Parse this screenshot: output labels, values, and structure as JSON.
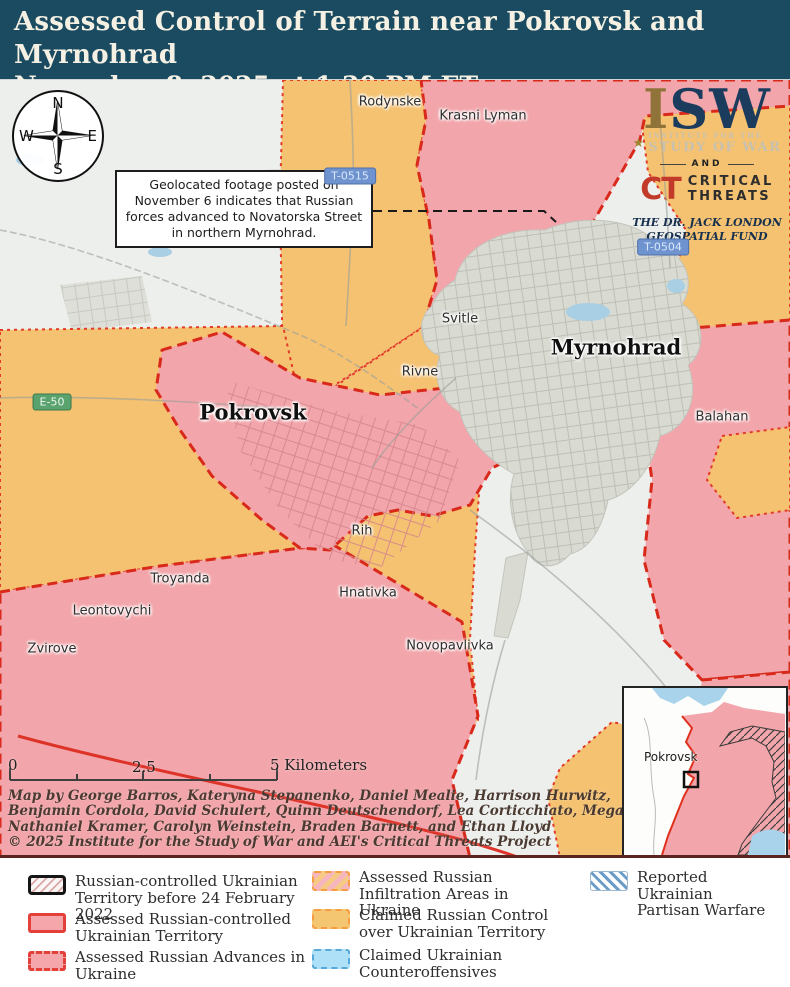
{
  "title": {
    "line1": "Assessed Control of Terrain near Pokrovsk and Myrnohrad",
    "line2": "November 8, 2025 at 1:30 PM ET"
  },
  "compass": {
    "n": "N",
    "e": "E",
    "s": "S",
    "w": "W"
  },
  "annotation": {
    "lines": [
      "Geolocated footage posted on",
      "November 6 indicates that Russian",
      "forces advanced to Novatorska Street",
      "in northern Myrnohrad."
    ]
  },
  "logo": {
    "isw_i": "I",
    "isw_sw": "SW",
    "star": "★",
    "institute": "INSTITUTE FOR THE",
    "study": "STUDY OF WAR",
    "and": "AND",
    "ct": "CT",
    "critical": "CRITICAL",
    "threats": "THREATS",
    "fund1": "THE DR. JACK LONDON",
    "fund2": "GEOSPATIAL FUND"
  },
  "roads": {
    "t0515": "T-0515",
    "t0504": "T-0504",
    "e50": "E-50"
  },
  "cities": [
    {
      "name": "Pokrovsk"
    },
    {
      "name": "Myrnohrad"
    }
  ],
  "towns": [
    {
      "name": "Rodynske"
    },
    {
      "name": "Krasni Lyman"
    },
    {
      "name": "Svitle"
    },
    {
      "name": "Rivne"
    },
    {
      "name": "Balahan"
    },
    {
      "name": "Rih"
    },
    {
      "name": "Troyanda"
    },
    {
      "name": "Hnativka"
    },
    {
      "name": "Leontovychi"
    },
    {
      "name": "Zvirove"
    },
    {
      "name": "Novopavlivka"
    }
  ],
  "scalebar": {
    "zero": "0",
    "mid": "2.5",
    "end": "5 Kilometers"
  },
  "credits": {
    "lines": [
      "Map by George Barros, Kateryna Stepanenko, Daniel Mealie, Harrison Hurwitz,",
      "Benjamin Cordola, David Schulert, Quinn Deutschendorf, Lea Corticchiato, Megan Ewert,",
      "Nathaniel Kramer, Carolyn Weinstein, Braden Barnett, and Ethan Lloyd",
      "© 2025 Institute for the Study of War and AEI's Critical Threats Project"
    ]
  },
  "inset": {
    "label": "Pokrovsk"
  },
  "legend": {
    "items": [
      {
        "label": "Russian-controlled Ukrainian Territory before 24 February 2022"
      },
      {
        "label": "Assessed Russian-controlled Ukrainian Territory"
      },
      {
        "label": "Assessed Russian Advances in Ukraine"
      },
      {
        "label": "Assessed Russian Infiltration Areas in Ukraine"
      },
      {
        "label": "Claimed Russian Control over Ukrainian Territory"
      },
      {
        "label": "Claimed Ukrainian Counteroffensives"
      },
      {
        "label": "Reported Ukrainian Partisan Warfare"
      }
    ]
  },
  "colors": {
    "title_bg": "#1B4B61",
    "assessed_russian_fill": "#F2A5AA",
    "russian_border_red": "#DA291C",
    "claimed_orange": "#F4C271",
    "orange_dash_border": "#F59D40",
    "counteroffensive_blue": "#ADE1F8",
    "counteroffensive_border": "#57A9D9",
    "partisan_blue": "#6B9DC8",
    "road_label_blue": "#6F93CF",
    "road_label_green": "#5AA26E",
    "urban_gray": "#D9DBD3",
    "map_base": "#EDEFEC"
  }
}
